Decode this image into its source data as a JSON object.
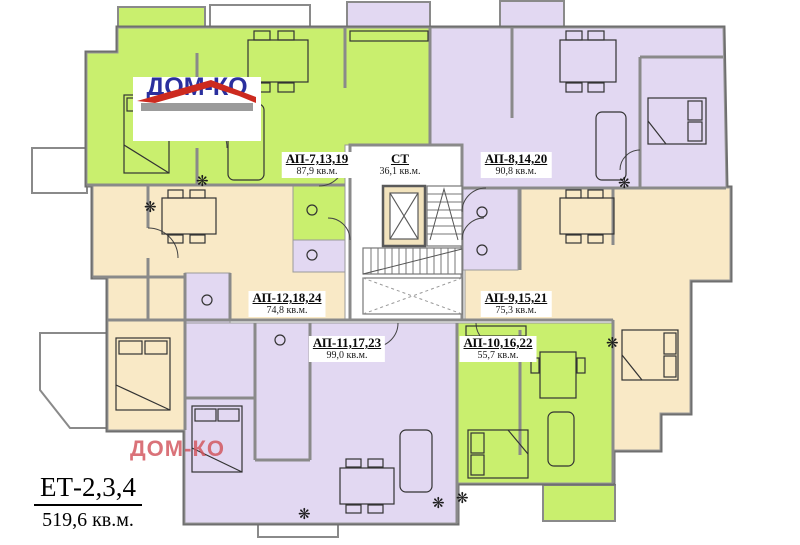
{
  "plan": {
    "floor": {
      "title": "ЕТ-2,3,4",
      "total_area": "519,6 кв.м."
    },
    "logo_text": "ДОМ-КО",
    "watermark_text": "ДОМ-КО",
    "apartments": [
      {
        "name": "АП-7,13,19",
        "area": "87,9 кв.м."
      },
      {
        "name": "СТ",
        "area": "36,1 кв.м."
      },
      {
        "name": "АП-8,14,20",
        "area": "90,8 кв.м."
      },
      {
        "name": "АП-12,18,24",
        "area": "74,8 кв.м."
      },
      {
        "name": "АП-9,15,21",
        "area": "75,3 кв.м."
      },
      {
        "name": "АП-11,17,23",
        "area": "99,0 кв.м."
      },
      {
        "name": "АП-10,16,22",
        "area": "55,7 кв.м."
      }
    ],
    "colors": {
      "green": "#c9ef6e",
      "lavender": "#e2d8f2",
      "beige": "#f9e9c6",
      "white": "#ffffff",
      "wall": "#8a8a8a",
      "outline": "#6f6f6f",
      "elevator_fill": "#f2e3bd",
      "logo_blue": "#2a2f9e",
      "logo_red": "#cc2a1f",
      "watermark_red": "#d2545c"
    }
  }
}
